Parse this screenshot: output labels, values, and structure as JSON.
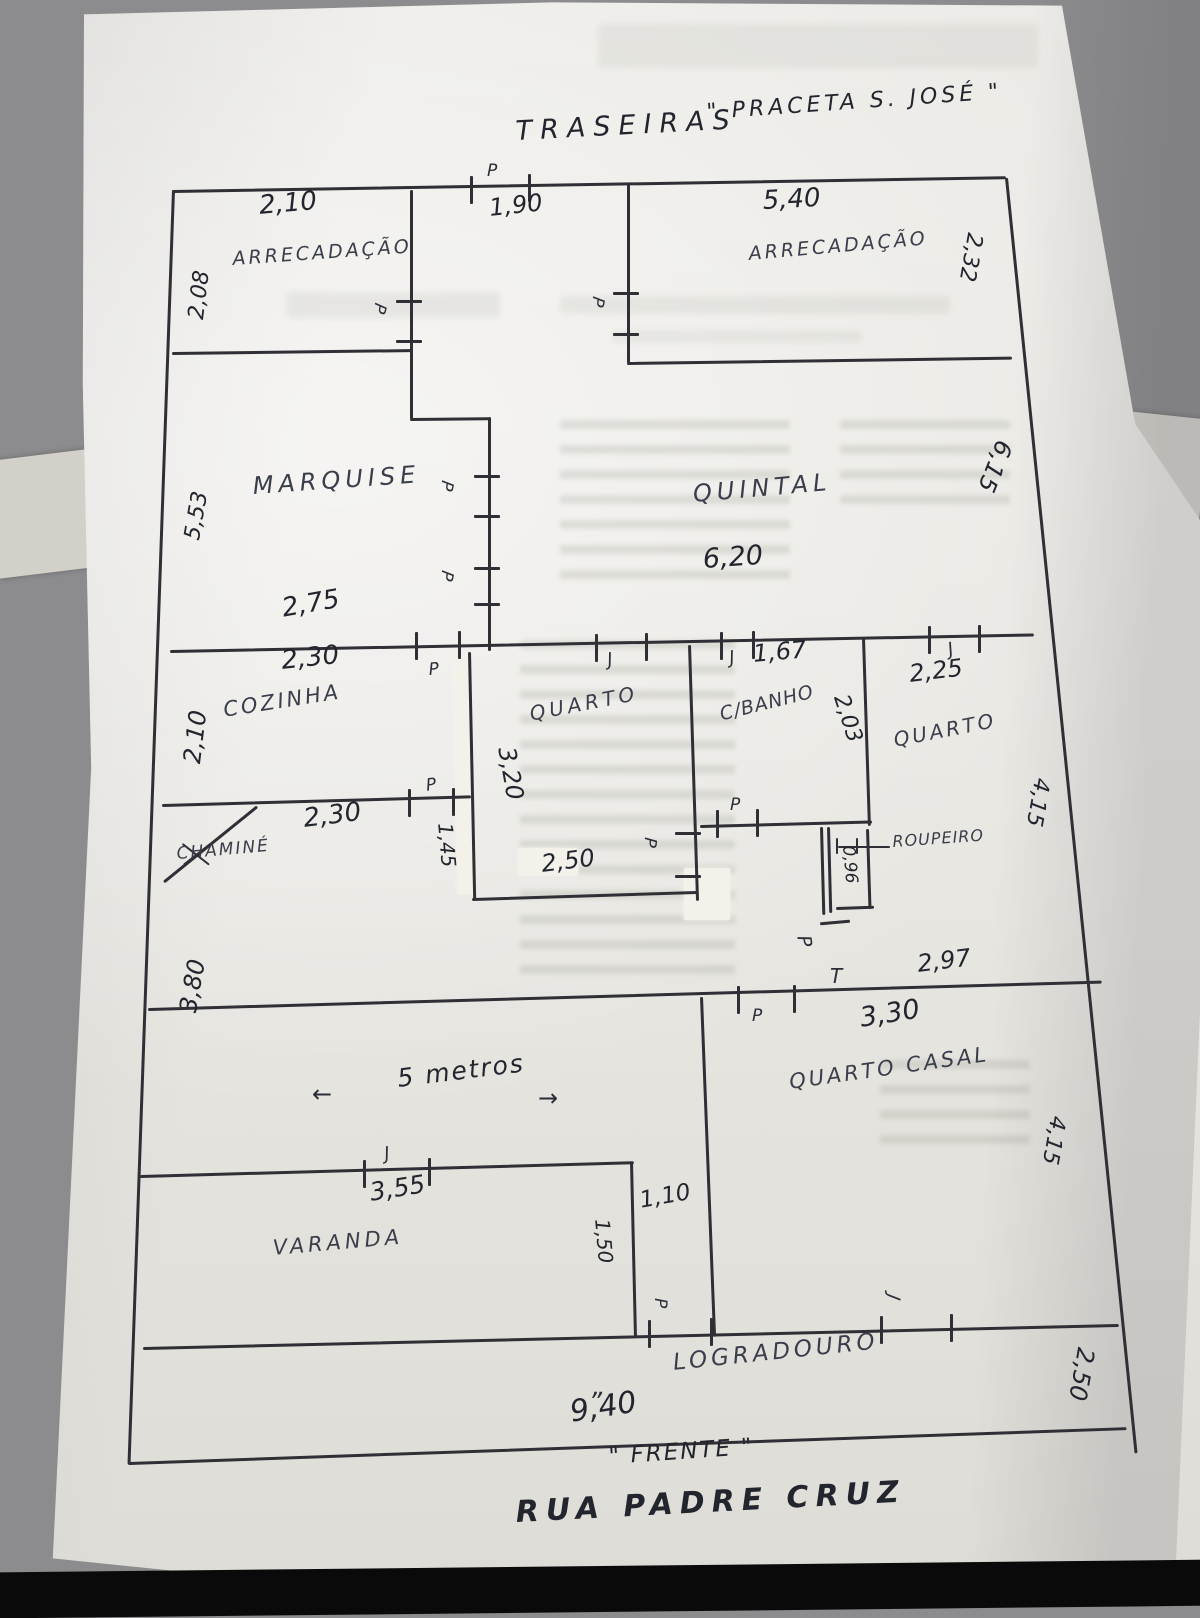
{
  "photo": {
    "background": "#8c8c8e",
    "paper": "#e9e7e2",
    "ink": "#2b2e37"
  },
  "header": {
    "traseiras": "TRASEIRAS",
    "praceta": "\" PRACETA S. JOSÉ \""
  },
  "markers": {
    "door": "P",
    "window": "J",
    "tee": "T",
    "quote": "„",
    "arrow_left": "←",
    "arrow_right": "→"
  },
  "gate": {
    "width": "1,90"
  },
  "storage_left": {
    "name": "ARRECADAÇÃO",
    "width": "2,10",
    "depth": "2,08"
  },
  "storage_right": {
    "name": "ARRECADAÇÃO",
    "width": "5,40",
    "depth": "2,32"
  },
  "marquise": {
    "name": "MARQUISE",
    "depth": "5,53",
    "width": "2,75"
  },
  "quintal": {
    "name": "QUINTAL",
    "width": "6,20",
    "depth": "6,15"
  },
  "cozinha": {
    "name": "COZINHA",
    "width_top": "2,30",
    "depth": "2,10",
    "width_bottom": "2,30"
  },
  "chamine": {
    "name": "CHAMINÉ"
  },
  "quarto_centro": {
    "name": "QUARTO",
    "depth": "3,20",
    "width": "2,50",
    "divider": "1,45"
  },
  "banho": {
    "name": "C/BANHO",
    "width": "1,67",
    "depth": "2,03"
  },
  "quarto_direita": {
    "name": "QUARTO",
    "width": "2,25",
    "depth": "4,15"
  },
  "roupeiro": {
    "name": "ROUPEIRO",
    "width": "0,96"
  },
  "sala": {
    "note": "5 metros",
    "lado": "3,80"
  },
  "quarto_casal": {
    "name": "QUARTO CASAL",
    "recuo": "2,97",
    "width": "3,30",
    "depth": "4,15"
  },
  "varanda": {
    "name": "VARANDA",
    "width": "3,55",
    "depth": "1,50"
  },
  "corredor": {
    "width": "1,10"
  },
  "logradouro": {
    "name": "LOGRADOURO",
    "frente": "9,40",
    "frente_label": "\" FRENTE \"",
    "lateral": "2,50"
  },
  "street": {
    "name": "RUA PADRE CRUZ"
  }
}
